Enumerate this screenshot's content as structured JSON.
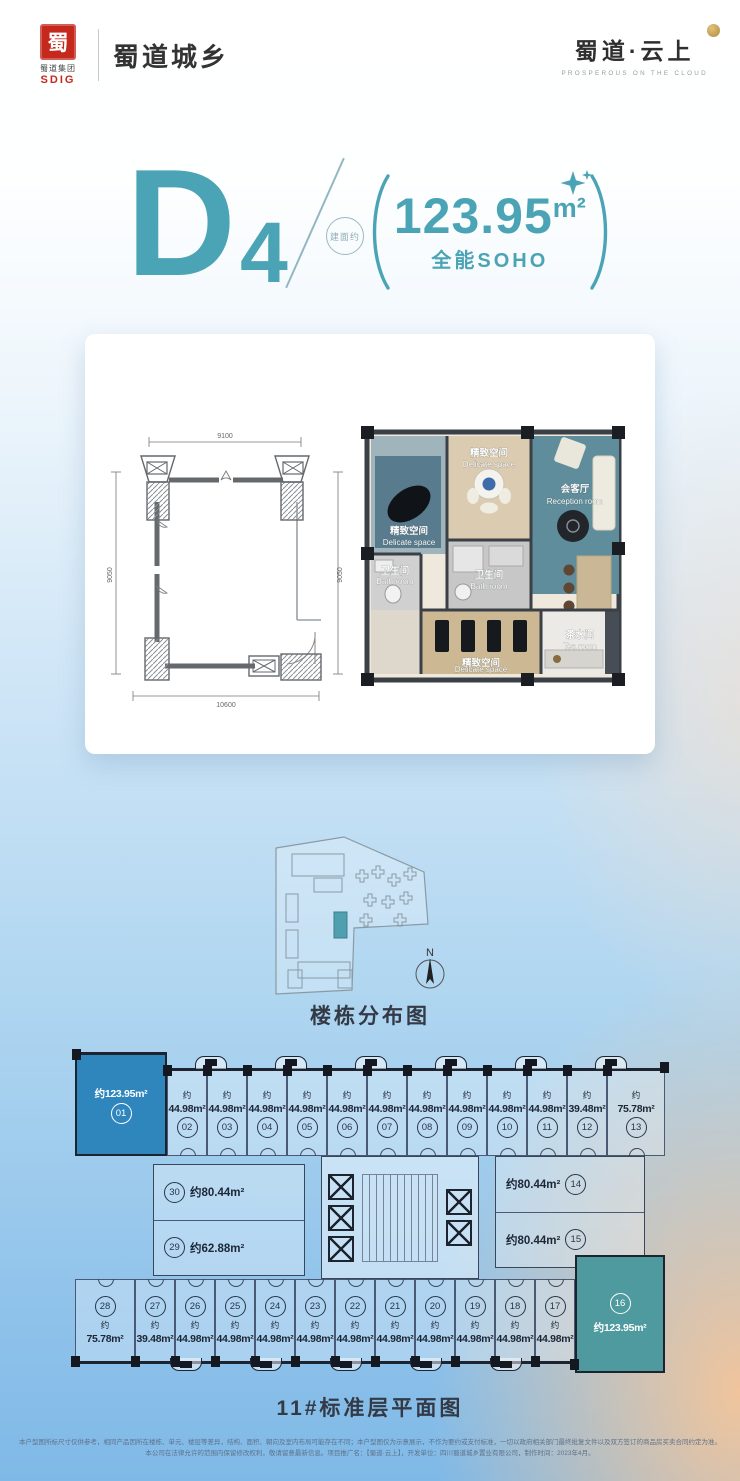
{
  "header": {
    "group_logo": {
      "seal_char": "蜀",
      "group_name": "蜀道集团",
      "group_abbr": "SDIG"
    },
    "brand_left": "蜀道城乡",
    "brand_right": "蜀道·云上",
    "brand_right_tagline": "PROSPEROUS ON THE CLOUD"
  },
  "title": {
    "letter": "D",
    "number": "4",
    "stamp_text": "建面约",
    "area_value": "123.95",
    "area_unit": "m²",
    "subtitle": "全能SOHO"
  },
  "unit_plan": {
    "dim_top": "9100",
    "dim_bottom": "10600",
    "dim_left": "9050",
    "dim_right": "9050",
    "rooms": {
      "top_left": {
        "cn": "精致空间",
        "en": "Delicate space"
      },
      "top_mid": {
        "cn": "精致空间",
        "en": "Delicate space"
      },
      "reception": {
        "cn": "会客厅",
        "en": "Reception room"
      },
      "bath_left": {
        "cn": "卫生间",
        "en": "Bath room"
      },
      "bath_mid": {
        "cn": "卫生间",
        "en": "Bath room"
      },
      "bottom_mid": {
        "cn": "精致空间",
        "en": "Delicate space"
      },
      "tea": {
        "cn": "茶水间",
        "en": "Tea room"
      }
    }
  },
  "site_plan": {
    "caption": "楼栋分布图",
    "compass": "N"
  },
  "standard_floor": {
    "caption": "11#标准层平面图",
    "top_row": [
      {
        "no": "01",
        "area": "约123.95m²",
        "highlight": true
      },
      {
        "no": "02",
        "prefix": "约",
        "area": "44.98m²"
      },
      {
        "no": "03",
        "prefix": "约",
        "area": "44.98m²"
      },
      {
        "no": "04",
        "prefix": "约",
        "area": "44.98m²"
      },
      {
        "no": "05",
        "prefix": "约",
        "area": "44.98m²"
      },
      {
        "no": "06",
        "prefix": "约",
        "area": "44.98m²"
      },
      {
        "no": "07",
        "prefix": "约",
        "area": "44.98m²"
      },
      {
        "no": "08",
        "prefix": "约",
        "area": "44.98m²"
      },
      {
        "no": "09",
        "prefix": "约",
        "area": "44.98m²"
      },
      {
        "no": "10",
        "prefix": "约",
        "area": "44.98m²"
      },
      {
        "no": "11",
        "prefix": "约",
        "area": "44.98m²"
      },
      {
        "no": "12",
        "prefix": "约",
        "area": "39.48m²"
      },
      {
        "no": "13",
        "prefix": "约",
        "area": "75.78m²"
      }
    ],
    "mid_units": [
      {
        "no": "30",
        "area": "约80.44m²"
      },
      {
        "no": "29",
        "area": "约62.88m²"
      },
      {
        "no": "14",
        "area": "约80.44m²"
      },
      {
        "no": "15",
        "area": "约80.44m²"
      }
    ],
    "bottom_row": [
      {
        "no": "28",
        "prefix": "约",
        "area": "75.78m²"
      },
      {
        "no": "27",
        "prefix": "约",
        "area": "39.48m²"
      },
      {
        "no": "26",
        "prefix": "约",
        "area": "44.98m²"
      },
      {
        "no": "25",
        "prefix": "约",
        "area": "44.98m²"
      },
      {
        "no": "24",
        "prefix": "约",
        "area": "44.98m²"
      },
      {
        "no": "23",
        "prefix": "约",
        "area": "44.98m²"
      },
      {
        "no": "22",
        "prefix": "约",
        "area": "44.98m²"
      },
      {
        "no": "21",
        "prefix": "约",
        "area": "44.98m²"
      },
      {
        "no": "20",
        "prefix": "约",
        "area": "44.98m²"
      },
      {
        "no": "19",
        "prefix": "约",
        "area": "44.98m²"
      },
      {
        "no": "18",
        "prefix": "约",
        "area": "44.98m²"
      },
      {
        "no": "17",
        "prefix": "约",
        "area": "44.98m²"
      }
    ],
    "unit16": {
      "no": "16",
      "area": "约123.95m²",
      "highlight": true
    }
  },
  "footer": {
    "line1": "本户型图所标尺寸仅供参考，相同产品因所在楼栋、单元、楼层等差异，结构、面积、朝向及室内布局可能存在不同；本户型图仅为示意展示，不作为要约或支付标准，一切以政府相关部门最终批复文件以及双方签订的商品房买卖合同约定为准。",
    "line2": "本公司在法律允许的范围内保留修改权利，敬请留意最新信息。项目推广名：【蜀道·云上】，开发单位：四川蜀道城乡置业有限公司，制作时间：2023年4月。"
  },
  "colors": {
    "accent": "#4BA4B5",
    "logo_red": "#C5281C",
    "gold": "#C9A55A",
    "highlight_blue": "#2E86BD",
    "highlight_teal": "#4E9A9E",
    "line_dark": "#1D2430"
  }
}
